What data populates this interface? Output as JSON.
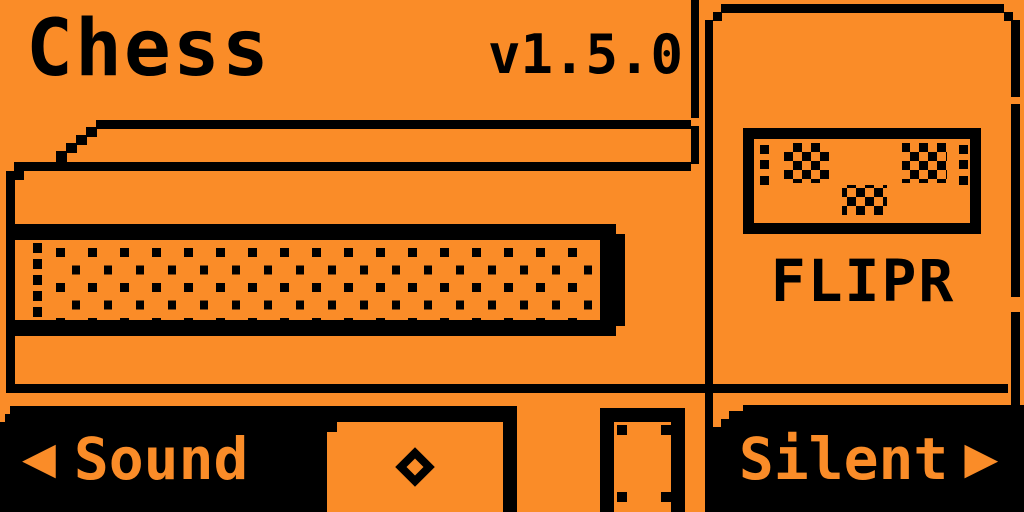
{
  "colors": {
    "background": "#FA8C28",
    "ink": "#000000"
  },
  "header": {
    "title": "Chess",
    "version": "v1.5.0"
  },
  "flipper_card": {
    "device_label": "FLIPR",
    "screen_icon": "dithered-dolphin-face"
  },
  "illustration": {
    "name": "grand-piano-with-keyboard-side-view"
  },
  "nav": {
    "sound": {
      "arrow": "◀",
      "label": "Sound"
    },
    "ok": {
      "icon": "diamond"
    },
    "silent": {
      "label": "Silent",
      "arrow": "▶"
    }
  }
}
